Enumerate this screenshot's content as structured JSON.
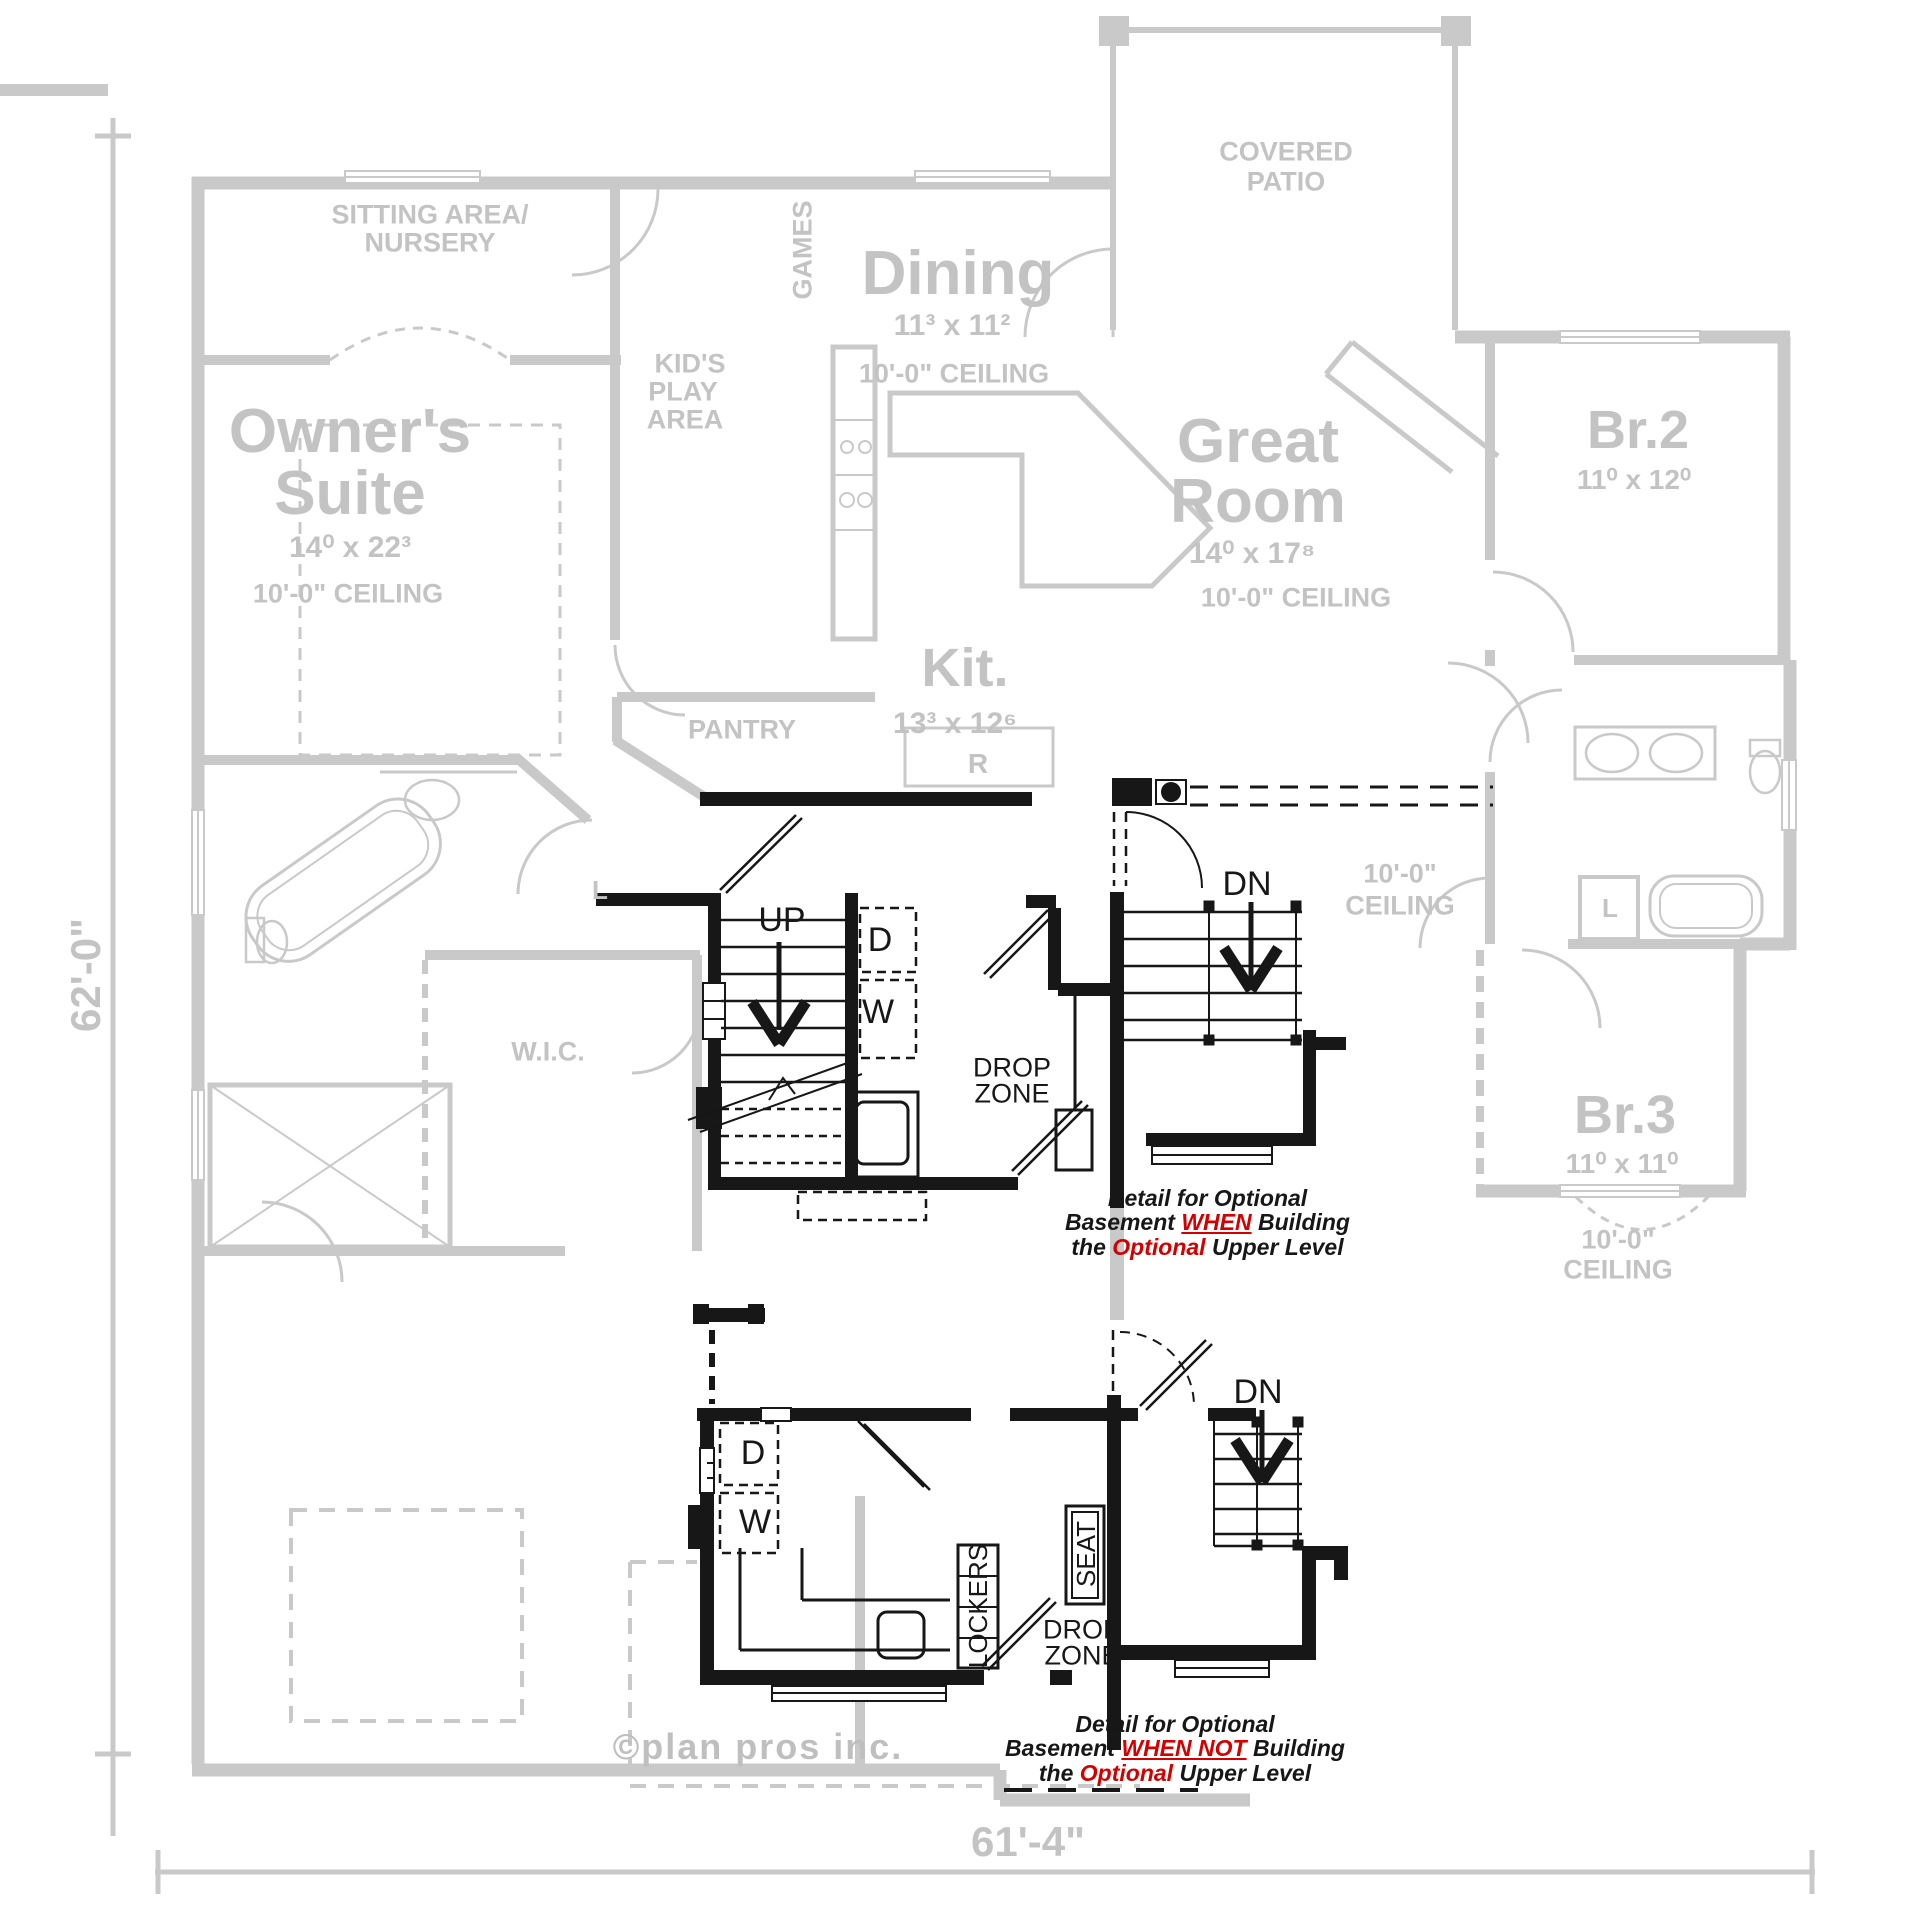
{
  "colors": {
    "plan_gray": "#c9c9c9",
    "label_gray": "#c3c3c3",
    "ink_black": "#171717",
    "accent_red": "#d40000",
    "watermark_gray": "#bfbfbf"
  },
  "rooms": {
    "sitting": {
      "line1": "SITTING AREA/",
      "line2": "NURSERY"
    },
    "owners_suite": {
      "line1": "Owner's",
      "line2": "Suite",
      "dims": "14⁰ x 22³",
      "ceiling": "10'-0\" CEILING"
    },
    "kids_play": {
      "line1": "KID'S",
      "line2": "PLAY",
      "line3": "AREA"
    },
    "games": {
      "label": "GAMES"
    },
    "dining": {
      "name": "Dining",
      "dims": "11³ x 11²",
      "ceiling": "10'-0\" CEILING"
    },
    "covered_patio": {
      "line1": "COVERED",
      "line2": "PATIO"
    },
    "great_room": {
      "line1": "Great",
      "line2": "Room",
      "dims": "14⁰ x 17⁸",
      "ceiling": "10'-0\" CEILING"
    },
    "kitchen": {
      "name": "Kit.",
      "dims": "13³ x 12⁶",
      "fridge": "R"
    },
    "pantry": {
      "label": "PANTRY"
    },
    "wic": {
      "label": "W.I.C."
    },
    "br2": {
      "name": "Br.2",
      "dims": "11⁰ x 12⁰"
    },
    "br3": {
      "name": "Br.3",
      "dims": "11⁰ x 11⁰",
      "ceiling_line1": "10'-0\"",
      "ceiling_line2": "CEILING"
    },
    "hall": {
      "ceiling_line1": "10'-0\"",
      "ceiling_line2": "CEILING"
    },
    "linen_closet": {
      "label": "L"
    }
  },
  "detail_when_building": {
    "stair_up": "UP",
    "stair_down": "DN",
    "dryer": "D",
    "washer": "W",
    "drop_zone_line1": "DROP",
    "drop_zone_line2": "ZONE",
    "caption": {
      "l1": "Detail for Optional",
      "l2a": "Basement ",
      "l2b": "WHEN",
      "l2c": " Building",
      "l3a": "the ",
      "l3b": "Optional",
      "l3c": " Upper Level"
    }
  },
  "detail_when_not_building": {
    "stair_down": "DN",
    "dryer": "D",
    "washer": "W",
    "seat": "SEAT",
    "lockers": "LOCKERS",
    "drop_zone_line1": "DROP",
    "drop_zone_line2": "ZONE",
    "caption": {
      "l1": "Detail for Optional",
      "l2a": "Basement ",
      "l2b": "WHEN NOT",
      "l2c": " Building",
      "l3a": "the ",
      "l3b": "Optional",
      "l3c": " Upper Level"
    }
  },
  "dimensions": {
    "left_total": "62'-0\"",
    "bottom_total": "61'-4\""
  },
  "watermark": "©plan pros inc."
}
